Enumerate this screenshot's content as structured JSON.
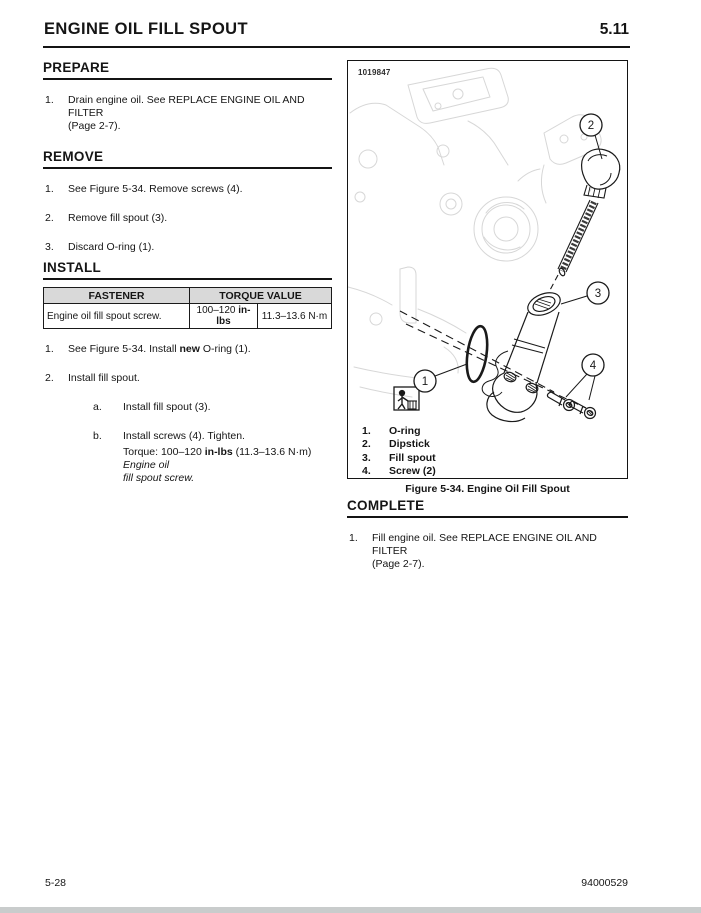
{
  "header": {
    "title": "ENGINE OIL FILL SPOUT",
    "section_number": "5.11"
  },
  "prepare": {
    "heading": "PREPARE",
    "items": [
      {
        "label": "1.",
        "level": 0,
        "segments": [
          {
            "t": "Drain engine oil. See REPLACE ENGINE OIL AND FILTER"
          },
          {
            "br": true
          },
          {
            "t": "(Page 2-7)."
          }
        ]
      }
    ]
  },
  "remove": {
    "heading": "REMOVE",
    "items": [
      {
        "label": "1.",
        "level": 0,
        "segments": [
          {
            "t": "See Figure 5-34. Remove screws (4)."
          }
        ]
      },
      {
        "label": "2.",
        "level": 0,
        "segments": [
          {
            "t": "Remove fill spout (3)."
          }
        ]
      },
      {
        "label": "3.",
        "level": 0,
        "segments": [
          {
            "t": "Discard O-ring (1)."
          }
        ]
      }
    ]
  },
  "install": {
    "heading": "INSTALL",
    "table": {
      "col1_header": "FASTENER",
      "col2_header": "TORQUE VALUE",
      "row": {
        "fastener": "Engine oil fill spout screw.",
        "torque_prefix": "100–120 ",
        "torque_unit_bold": "in-lbs",
        "torque_metric": "11.3–13.6 N·m"
      }
    },
    "items": [
      {
        "label": "1.",
        "level": 0,
        "segments": [
          {
            "t": "See Figure 5-34. Install "
          },
          {
            "t": "new",
            "b": true
          },
          {
            "t": " O-ring (1)."
          }
        ]
      },
      {
        "label": "2.",
        "level": 0,
        "segments": [
          {
            "t": "Install fill spout."
          }
        ]
      },
      {
        "label": "a.",
        "level": 1,
        "segments": [
          {
            "t": "Install fill spout (3)."
          }
        ]
      },
      {
        "label": "b.",
        "level": 1,
        "segments": [
          {
            "t": "Install screws (4). Tighten."
          }
        ]
      },
      {
        "label": "",
        "level": 1,
        "tight": true,
        "segments": [
          {
            "t": "Torque: 100–120 "
          },
          {
            "t": "in-lbs",
            "b": true
          },
          {
            "t": " (11.3–13.6 N·m) "
          },
          {
            "t": "Engine oil",
            "i": true
          },
          {
            "br": true
          },
          {
            "t": "fill spout screw.",
            "i": true
          }
        ]
      }
    ]
  },
  "figure": {
    "id_number": "1019847",
    "caption": "Figure 5-34. Engine Oil Fill Spout",
    "callouts": [
      "1",
      "2",
      "3",
      "4"
    ],
    "legend": [
      {
        "num": "1.",
        "label": "O-ring"
      },
      {
        "num": "2.",
        "label": "Dipstick"
      },
      {
        "num": "3.",
        "label": "Fill spout"
      },
      {
        "num": "4.",
        "label": "Screw (2)"
      }
    ]
  },
  "complete": {
    "heading": "COMPLETE",
    "items": [
      {
        "label": "1.",
        "level": 0,
        "segments": [
          {
            "t": "Fill engine oil. See REPLACE ENGINE OIL AND FILTER"
          },
          {
            "br": true
          },
          {
            "t": "(Page 2-7)."
          }
        ]
      }
    ]
  },
  "footer": {
    "page_number": "5-28",
    "document_number": "94000529"
  }
}
